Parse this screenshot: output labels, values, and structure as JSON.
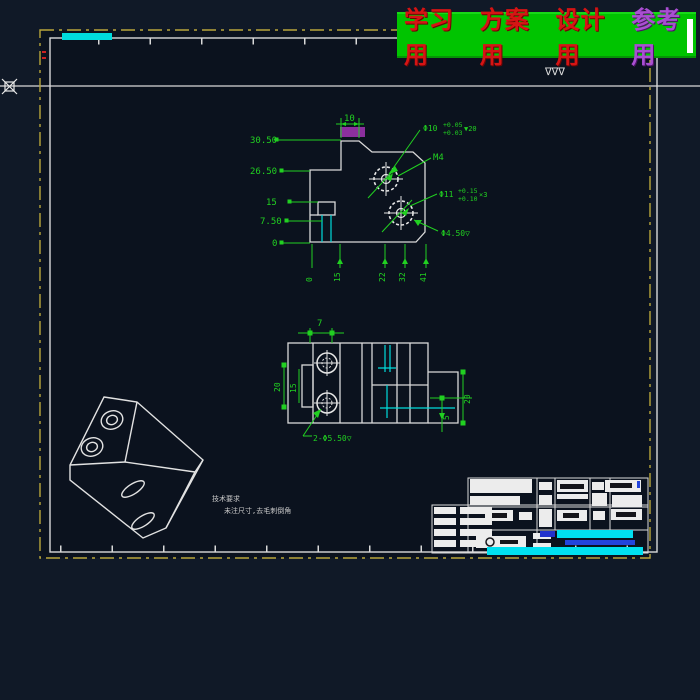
{
  "banner": {
    "items": [
      {
        "text": "学习用"
      },
      {
        "text": "方案用"
      },
      {
        "text": "设计用"
      },
      {
        "text": "参考用"
      }
    ]
  },
  "surface_marks": "∇∇∇",
  "front_view": {
    "left_dims": [
      "30.50",
      "26.50",
      "15",
      "7.50",
      "0"
    ],
    "top_dim": "10",
    "bottom_dims": [
      "0",
      "15",
      "22",
      "32",
      "41"
    ],
    "hole_top": {
      "dia": "Φ10",
      "tol_up": "+0.05",
      "tol_dn": "+0.03",
      "depth": "▼20"
    },
    "thread": "M4",
    "hole_mid": {
      "dia": "Φ11",
      "tol_up": "+0.15",
      "tol_dn": "+0.10",
      "qty": "×3"
    },
    "hole_small": "Φ4.50▽"
  },
  "plan_view": {
    "top_dim": "7",
    "left_dim_outer": "20",
    "left_dim_inner": "15",
    "right_dim": "20",
    "small_dim": "5",
    "note": "2-Φ5.50▽"
  },
  "tech_note": {
    "line1": "技术要求",
    "line2": "未注尺寸,去毛刺倒角"
  },
  "colors": {
    "background": "#101927",
    "sheet": "#0b121e",
    "line_white": "#d9d9d9",
    "border_yellow": "#b9a63b",
    "dimension_green": "#21d021",
    "cyan": "#00dcdc",
    "banner_green": "#00c400",
    "banner_red": "#d61414",
    "banner_purple": "#a94fd2",
    "highlight_cyan": "#00e0f0",
    "highlight_blue": "#2244dd",
    "magenta": "#a335b5"
  }
}
